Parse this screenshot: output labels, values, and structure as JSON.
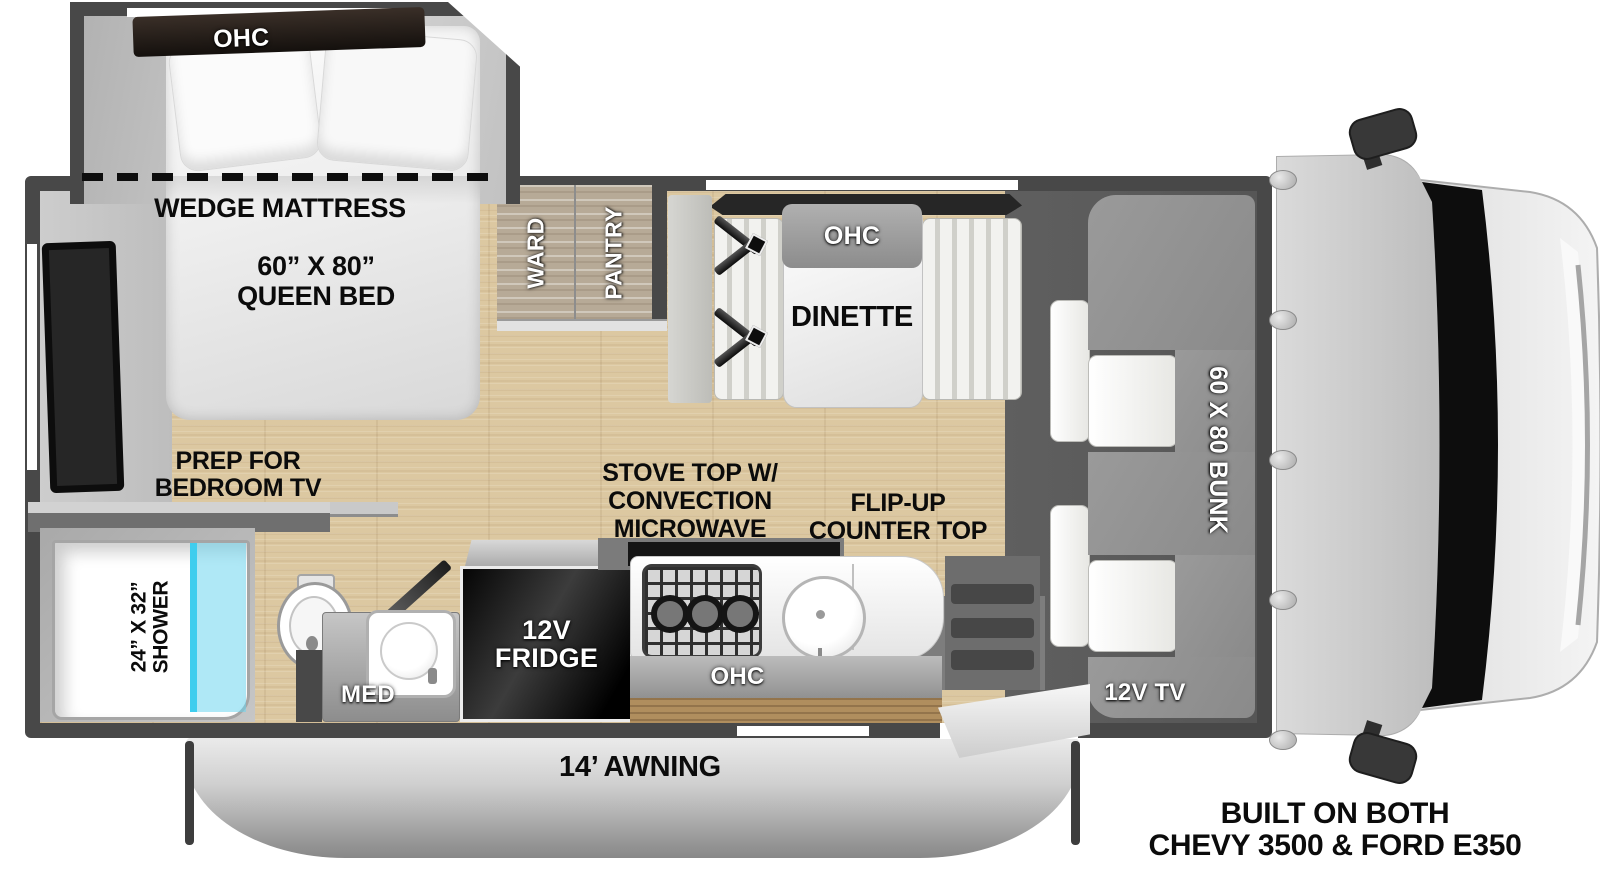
{
  "bedroom": {
    "ohc": "OHC",
    "wedge_mattress": "WEDGE MATTRESS",
    "bed_size": "60” X 80”",
    "bed_type": "QUEEN BED",
    "tv_prep_l1": "PREP FOR",
    "tv_prep_l2": "BEDROOM TV"
  },
  "bathroom": {
    "shower_size": "24” X 32”",
    "shower": "SHOWER",
    "med": "MED"
  },
  "kitchen": {
    "fridge_l1": "12V",
    "fridge_l2": "FRIDGE",
    "stove_l1": "STOVE TOP W/",
    "stove_l2": "CONVECTION",
    "stove_l3": "MICROWAVE",
    "flip_l1": "FLIP-UP",
    "flip_l2": "COUNTER TOP",
    "ohc": "OHC"
  },
  "dinette": {
    "label": "DINETTE",
    "ohc": "OHC"
  },
  "storage": {
    "ward": "WARD",
    "pantry": "PANTRY"
  },
  "cab_over": {
    "bunk": "60 X 80 BUNK",
    "tv": "12V TV"
  },
  "exterior": {
    "awning": "14’ AWNING"
  },
  "footer": {
    "l1": "BUILT ON BOTH",
    "l2": "CHEVY 3500 & FORD E350"
  },
  "colors": {
    "wall": "#484848",
    "floor_wood": "#dcc8a1",
    "bunk_gray": "#909090",
    "shower_glass": "#45cfee",
    "windshield_black": "#0d0d0d"
  }
}
